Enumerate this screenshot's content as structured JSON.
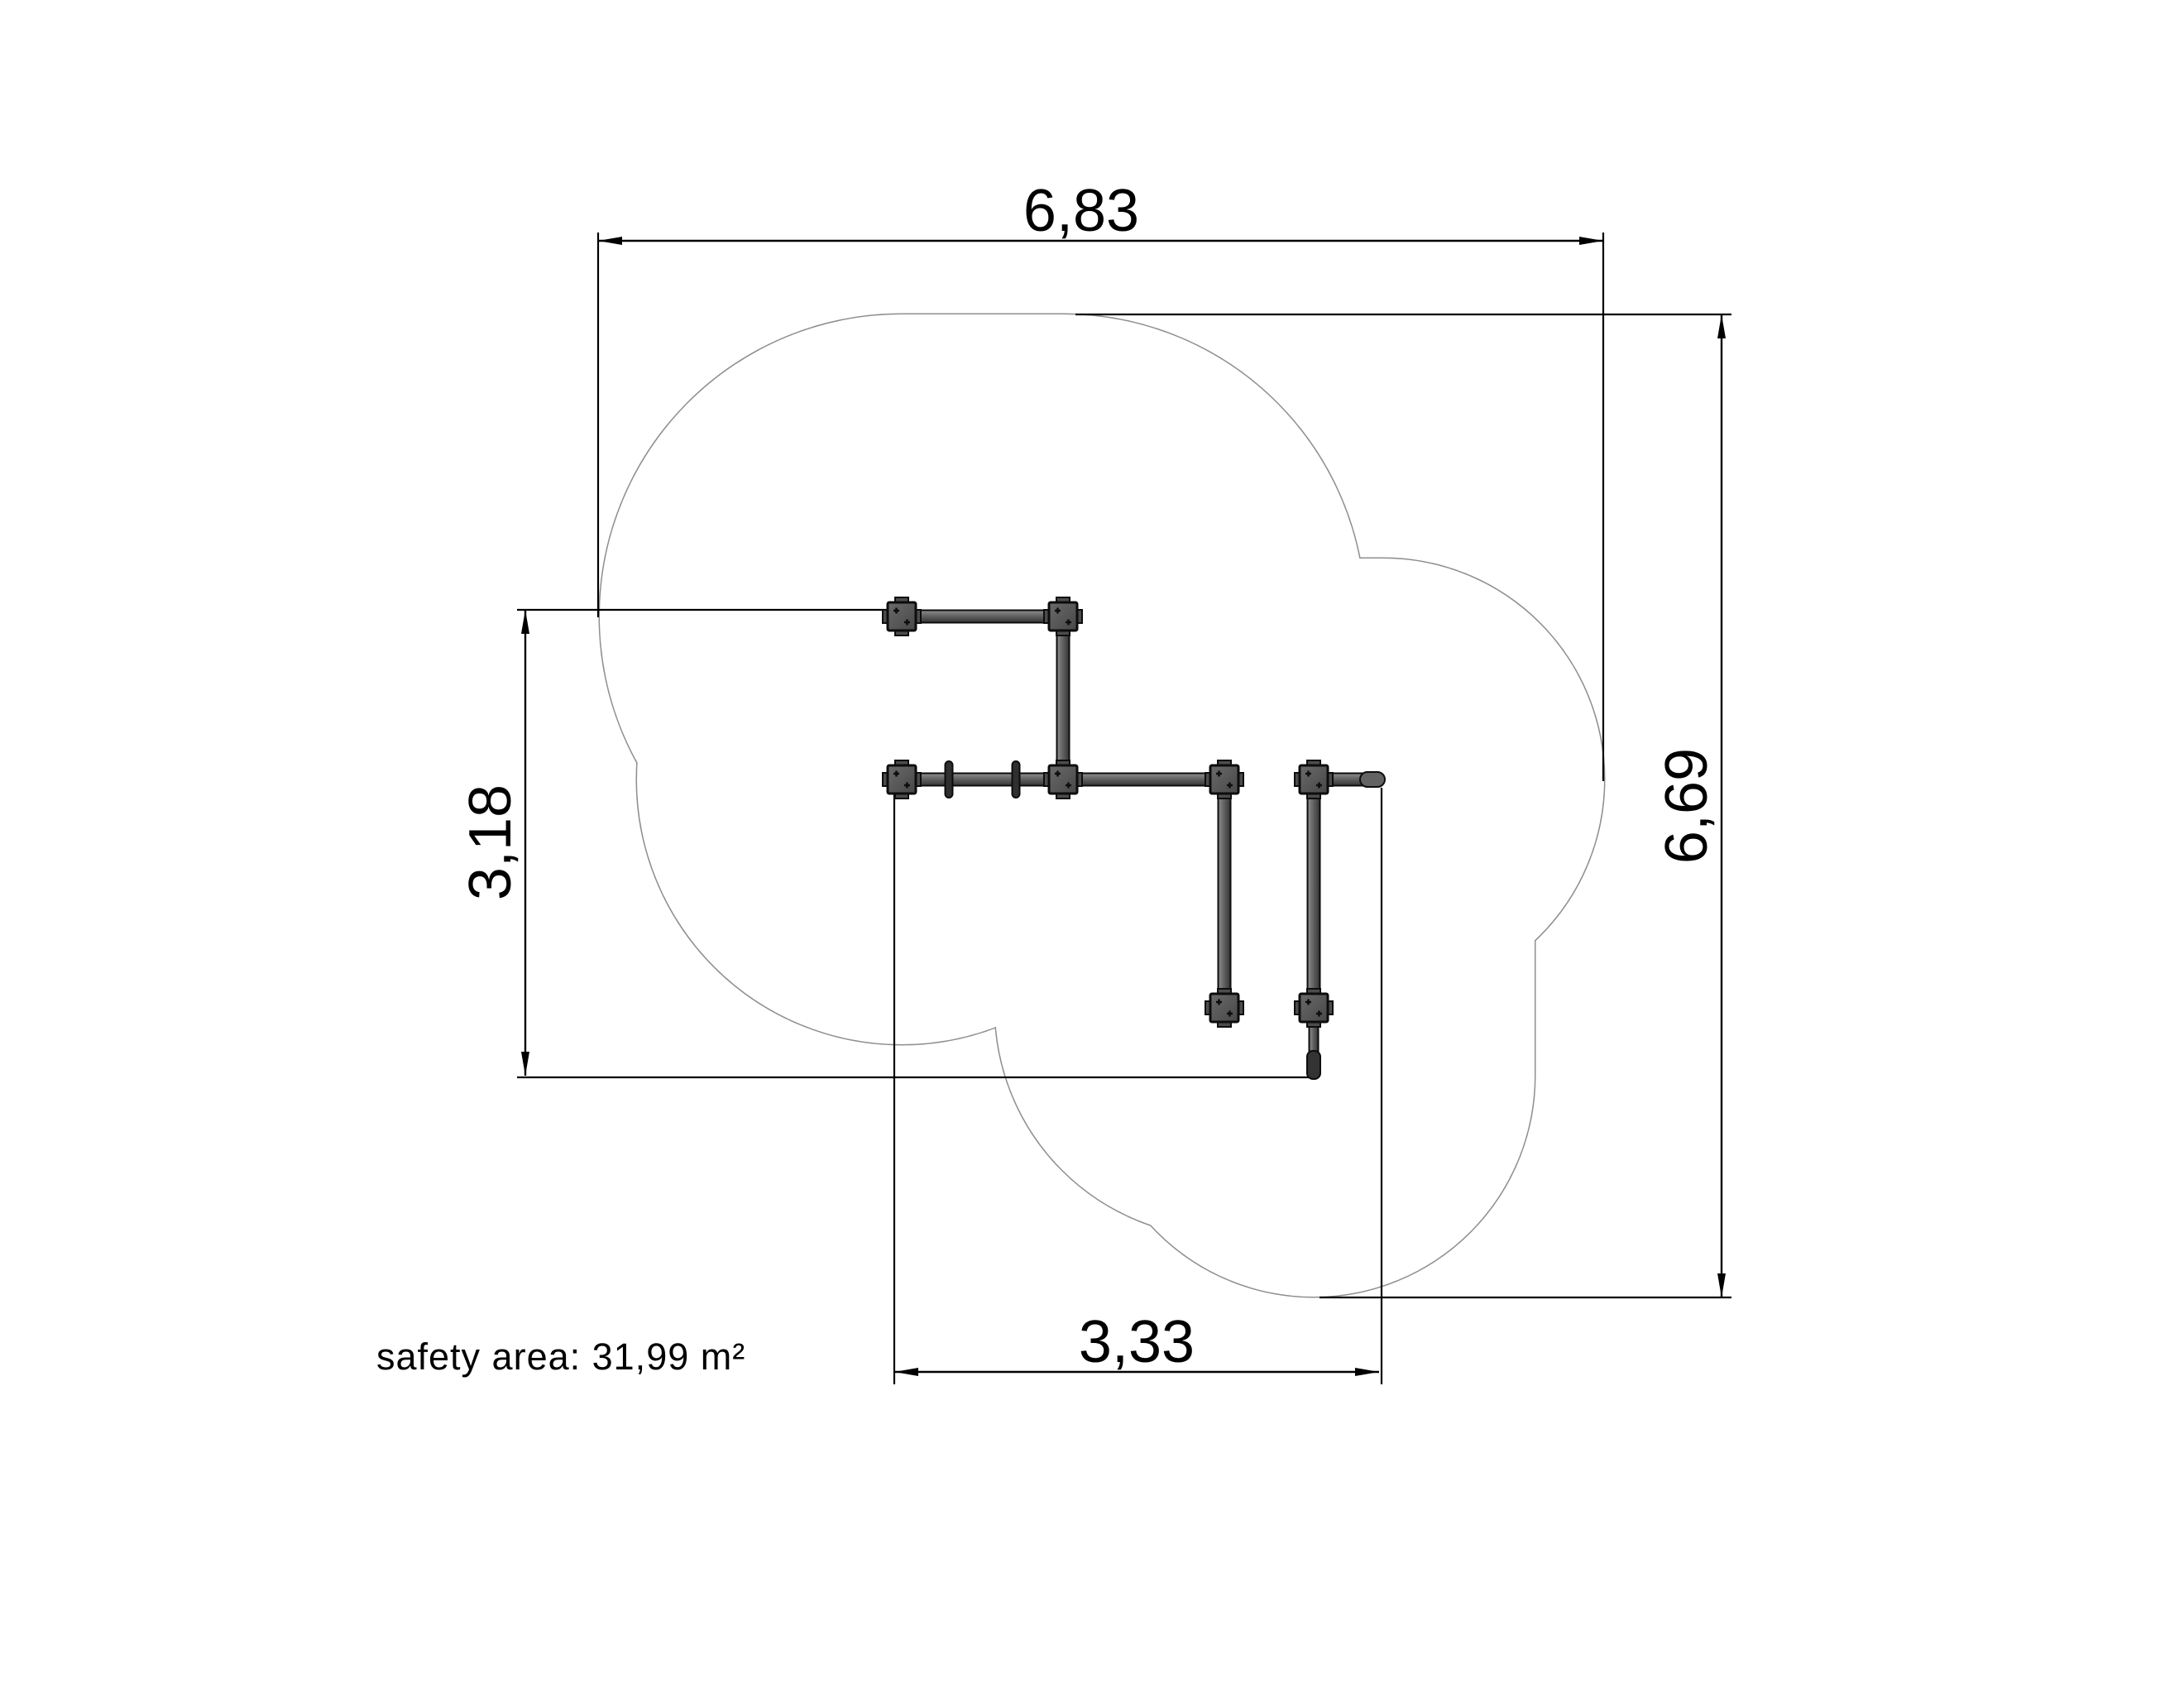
{
  "drawing": {
    "type": "playground-equipment-safety-plan",
    "dimensions": {
      "top": {
        "label": "6,83"
      },
      "right": {
        "label": "6,69"
      },
      "left": {
        "label": "3,18"
      },
      "bottom": {
        "label": "3,33"
      }
    },
    "safety_area": {
      "label": "safety area: 31,99 m²"
    },
    "colors": {
      "background": "#ffffff",
      "dimension_line": "#000000",
      "safety_outline": "#8f8f8f",
      "equipment_outline": "#0d0d0d",
      "equipment_fill_dark": "#343434",
      "equipment_fill_mid": "#5f5f5f",
      "equipment_fill_light": "#8f8f8f"
    }
  }
}
